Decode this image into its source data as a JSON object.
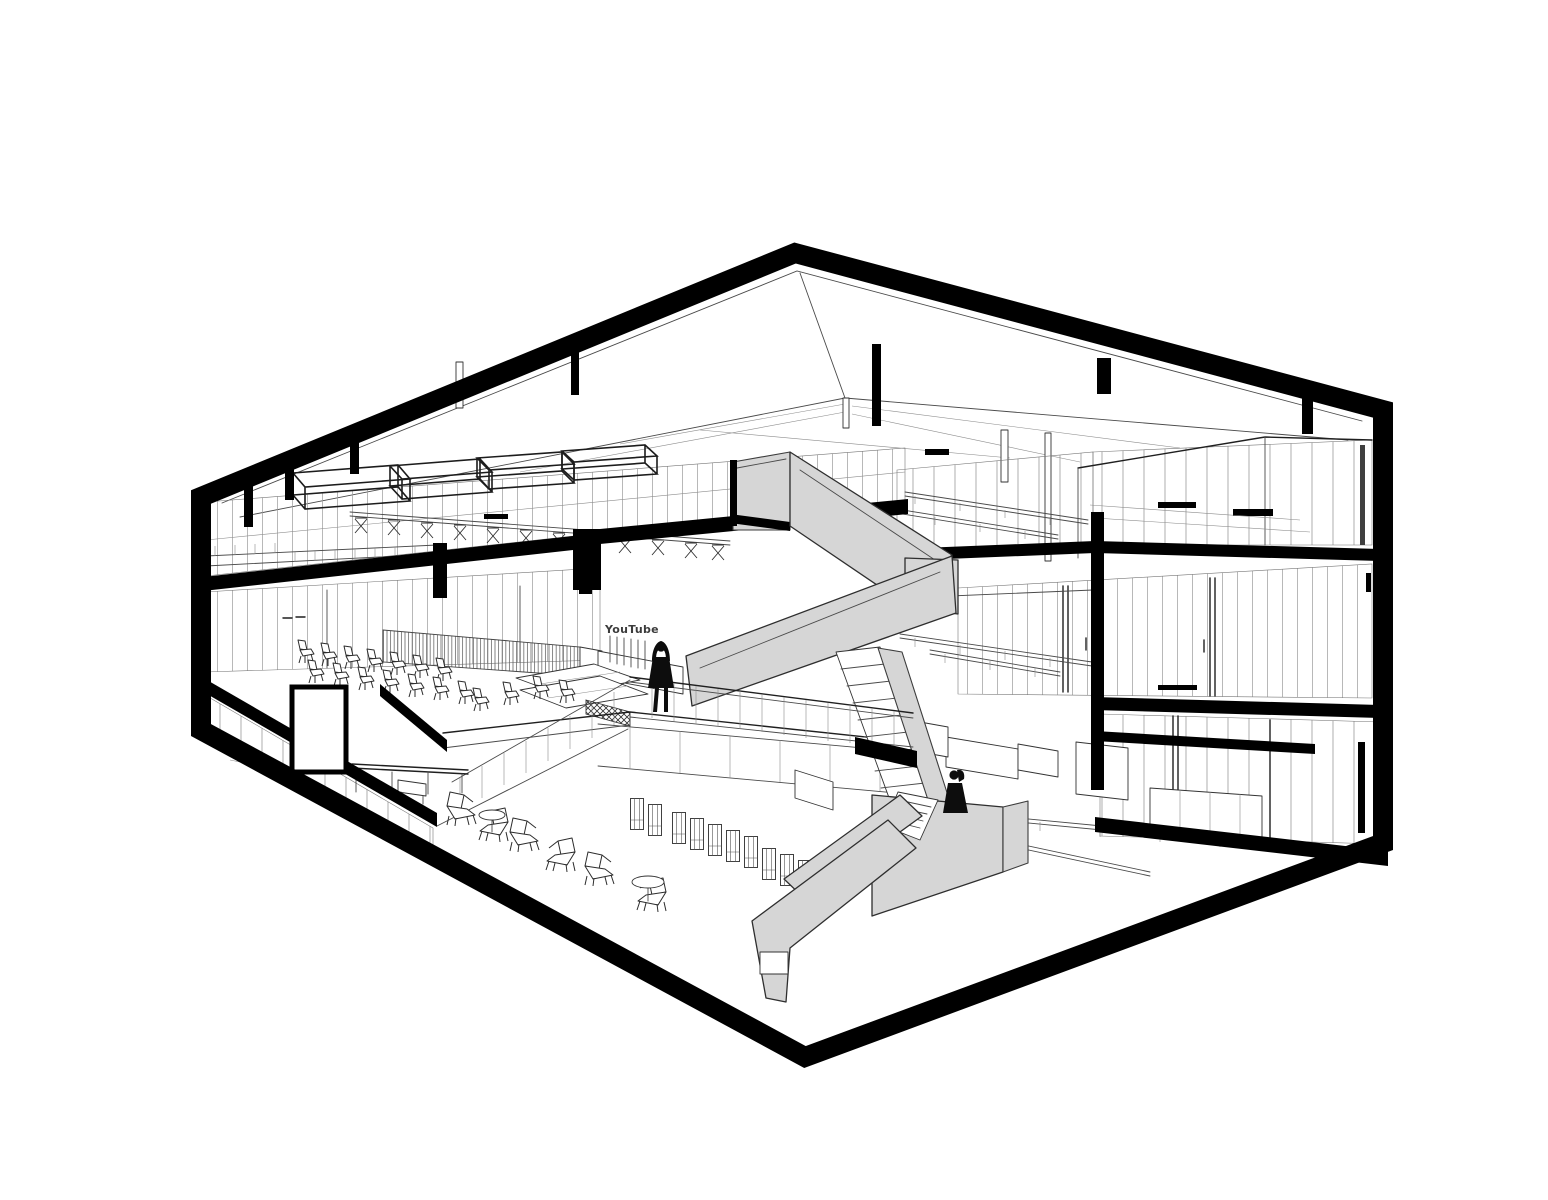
{
  "title": "Sectional perspective drawing of a three-storey office building",
  "colors": {
    "bg": "#ffffff",
    "ink": "#000000",
    "stair": "#d6d6d6",
    "silhouette": "#0d0d0d"
  },
  "sign": {
    "text": "YouTube"
  },
  "scene": {
    "type": "architectural-sectional-perspective",
    "style": "black line drawing with gray central staircase",
    "floors": [
      {
        "name": "ground-floor",
        "furniture": {
          "lounge_chairs": 6,
          "round_coffee_tables": 2,
          "high_frame_stools": 10,
          "long_bench": 1,
          "side_table": 1,
          "service_counters": 3,
          "long_tables": 2
        },
        "features": [
          "dark double door",
          "low partition wall",
          "glass rooms right"
        ]
      },
      {
        "name": "second-floor-mezzanine",
        "furniture": {
          "audience_chairs": 18,
          "louvered_counter": 1,
          "white_sofa_modules": 2,
          "slatted_crate": 1
        },
        "features": [
          "letter sign on posts",
          "glass parapet",
          "person with raised arms"
        ]
      },
      {
        "name": "third-floor",
        "furniture": {
          "suspended_light_frames": 4,
          "bar_counter_with_x_stools": 1,
          "x_stools": 12,
          "long_work_tables": 4
        },
        "features": [
          "glass meeting rooms",
          "balustrade"
        ]
      }
    ],
    "staircase": {
      "flights": 4,
      "landings": 2,
      "material_color": "#d6d6d6"
    },
    "people": [
      {
        "pose": "arms-raised",
        "location": "second-floor-mezzanine"
      },
      {
        "pose": "standing-with-ponytail",
        "location": "lower-stair-landing"
      }
    ]
  }
}
